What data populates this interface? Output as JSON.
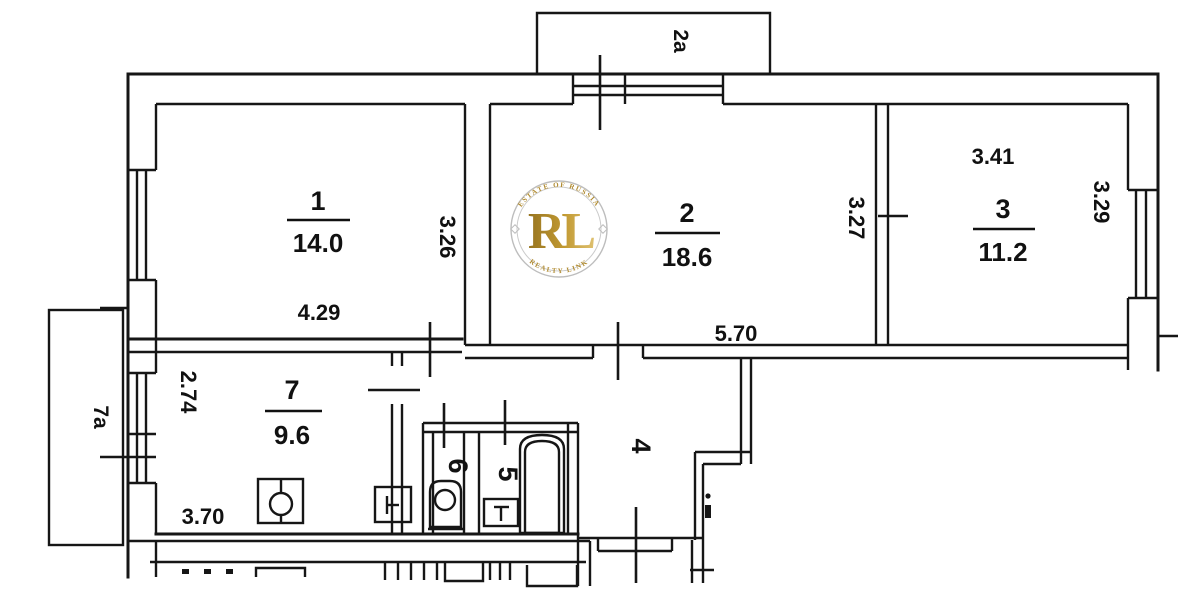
{
  "rooms": {
    "room1": {
      "number": "1",
      "area": "14.0"
    },
    "room2": {
      "number": "2",
      "area": "18.6"
    },
    "room3": {
      "number": "3",
      "area": "11.2"
    },
    "room4": {
      "number": "4"
    },
    "room5": {
      "number": "5"
    },
    "room6": {
      "number": "6"
    },
    "room7": {
      "number": "7",
      "area": "9.6"
    }
  },
  "balconies": {
    "balcony2a": {
      "label": "2a"
    },
    "balcony7a": {
      "label": "7a"
    }
  },
  "dimensions": {
    "room1_width": "4.29",
    "room1_depth": "3.26",
    "room2_width": "5.70",
    "room2_depth": "3.27",
    "room3_width": "3.41",
    "room3_depth": "3.29",
    "room7_width": "3.70",
    "room7_depth": "2.74"
  },
  "watermark": {
    "arc_top": "ESTATE OF RUSSIA",
    "arc_bottom": "REALTY LINK",
    "initials": "RL",
    "gold_color": "#b08a2e",
    "ring_color": "#bdbdbd"
  },
  "colors": {
    "line": "#161616",
    "background": "#ffffff"
  }
}
